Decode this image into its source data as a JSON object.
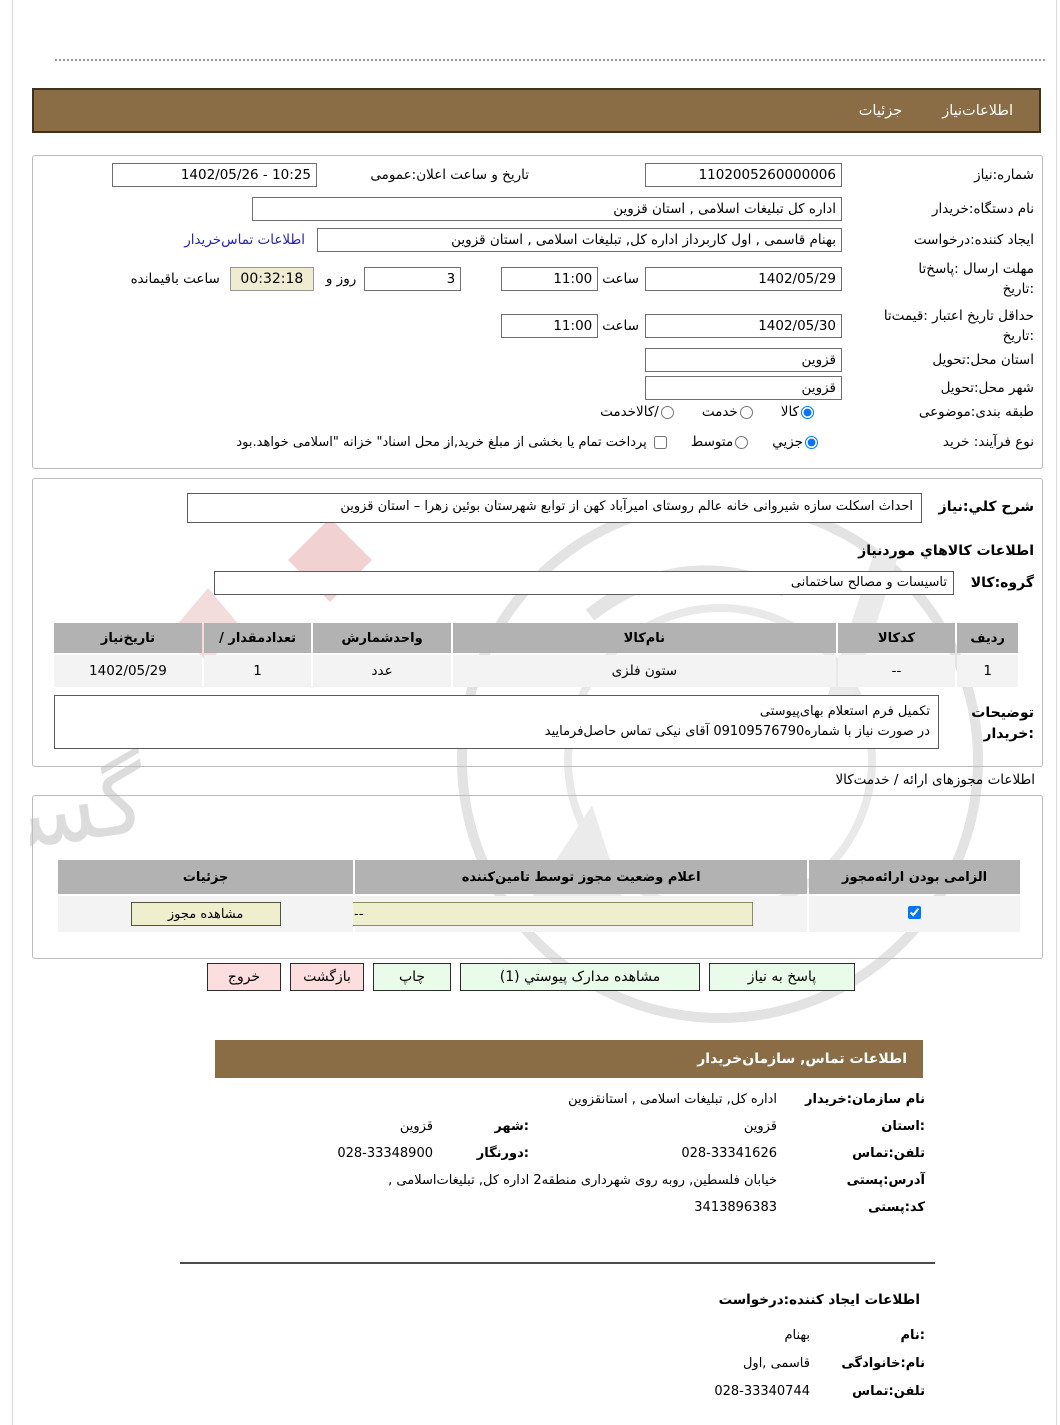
{
  "top_tabs": {
    "need_info_label": "اطلاعات‌نیاز",
    "details_label": "جزئیات"
  },
  "form": {
    "need_number_label": "شماره:نیاز",
    "need_number_value": "1102005260000006",
    "announce_label": "تاریخ و ساعت اعلان:عمومی",
    "announce_value": "10:25 - 1402/05/26",
    "buyer_org_label": "نام دستگاه:خریدار",
    "buyer_org_value": "اداره کل تبلیغات اسلامی , استان قزوین",
    "creator_label": "ایجاد کننده:درخواست",
    "creator_value": "بهنام قاسمی , اول کاربرداز اداره کل, تبلیغات اسلامی , استان قزوین",
    "buyer_contact_link": "اطلاعات تماس‌خریدار",
    "deadline_label_line1": "مهلت ارسال :پاسخ‌تا",
    "deadline_label_line2": ":تاریخ",
    "deadline_date": "1402/05/29",
    "hour_label": "ساعت",
    "deadline_time": "11:00",
    "days_value": "3",
    "days_label": "روز و",
    "countdown_value": "00:32:18",
    "remaining_label": "ساعت باقیمانده",
    "validity_label_line1": "حداقل تاریخ اعتبار :قیمت‌تا",
    "validity_label_line2": ":تاریخ",
    "validity_date": "1402/05/30",
    "validity_time": "11:00",
    "province_label": "استان محل:تحویل",
    "province_value": "قزوین",
    "city_label": "شهر محل:تحویل",
    "city_value": "قزوین",
    "classification_label": "طبقه بندی:موضوعی",
    "class_option_goods": "کالا",
    "class_option_service": "خدمت",
    "class_option_both": "/کالاخدمت",
    "process_label": "نوع فرآیند: خرید",
    "process_option_minor": "جزیي",
    "process_option_medium": "متوسط",
    "treasury_note": "پرداخت تمام یا بخشی از مبلغ خرید,از محل اسناد\" خزانه \"اسلامی خواهد.بود"
  },
  "need_desc": {
    "label": "شرح کلي:نیاز",
    "value": "احداث اسکلت سازه شیروانی خانه عالم روستای امیرآباد کهن از توابع شهرستان بوئین زهرا – استان قزوین",
    "goods_info_heading": "اطلاعات کالاهاي موردنیاز",
    "group_label": "گروه:کالا",
    "group_value": "تاسیسات و مصالح ساختمانی"
  },
  "goods_table": {
    "headers": [
      "ردیف",
      "کدکالا",
      "نام‌کالا",
      "واحدشمارش",
      "تعدادمقدار /",
      "تاریخ‌نیاز"
    ],
    "rows": [
      [
        "1",
        "--",
        "ستون فلزی",
        "عدد",
        "1",
        "1402/05/29"
      ]
    ]
  },
  "buyer_notes": {
    "label_line1": "توضیحات",
    "label_line2": ":خریدار",
    "line1": "تکمیل فرم استعلام بهای‌پیوستی",
    "line2": "در صورت نیاز با شماره09109576790 آقای نیکی تماس حاصل‌فرمایید"
  },
  "permits": {
    "heading": "اطلاعات مجوزهای ارائه / خدمت‌کالا",
    "headers": [
      "الزامی بودن ارائه‌مجوز",
      "اعلام وضعیت مجوز توسط تامین‌کننده",
      "جزئیات"
    ],
    "status_value": "--",
    "details_button": "مشاهده مجوز"
  },
  "actions": {
    "respond": "پاسخ به نیاز",
    "view_docs": "مشاهده مدارک پیوستي (1)",
    "print": "چاپ",
    "back": "بازگشت",
    "exit": "خروج"
  },
  "buyer_contact": {
    "heading": "اطلاعات  تماس, سازمان‌خریدار",
    "org_label": "نام سازمان:خریدار",
    "org_value": "اداره کل, تبلیغات اسلامی , استانقزوین",
    "province_label": ":استان",
    "province_value": "قزوین",
    "city_label": ":شهر",
    "city_value": "قزوین",
    "phone_label": "تلفن:تماس",
    "phone_value": "028-33341626",
    "fax_label": ":دورنگار",
    "fax_value": "028-33348900",
    "address_label": "آدرس:پستی",
    "address_value": "خیابان فلسطین, روبه روی شهرداری منطقه2 اداره کل, تبلیغات‌اسلامی ,",
    "postal_label": "کد:پستی",
    "postal_value": "3413896383"
  },
  "requester": {
    "heading": "اطلاعات ایجاد کننده:درخواست",
    "name_label": ":نام",
    "name_value": "بهنام",
    "lastname_label": "نام:خانوادگی",
    "lastname_value": "قاسمی ,اول",
    "phone_label": "تلفن:تماس",
    "phone_value": "028-33340744"
  },
  "watermark": {
    "text": "گستران"
  },
  "colors": {
    "brown_bar": "#8a6d44",
    "link_blue": "#2424bb",
    "beige_field": "#efeecd",
    "countdown_bg": "#f0ecd2",
    "green_button": "#e9fbe9",
    "pink_button": "#fcdede",
    "table_header": "#b2b2b2"
  }
}
